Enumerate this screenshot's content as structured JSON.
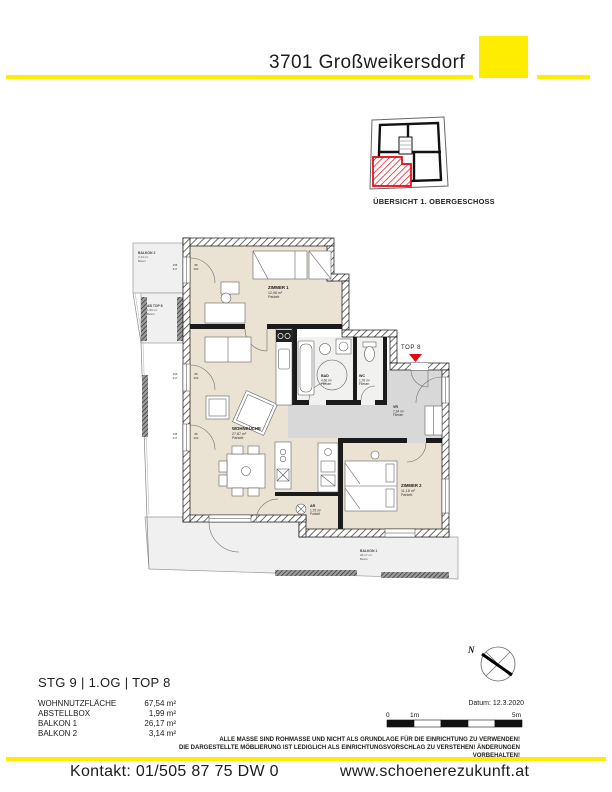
{
  "header": {
    "title": "3701 Großweikersdorf"
  },
  "overview": {
    "caption": "ÜBERSICHT 1. OBERGESCHOSS"
  },
  "plan": {
    "unit_marker": "TOP 8",
    "rooms": {
      "zimmer1": {
        "name": "ZIMMER 1",
        "area": "12,98 m²",
        "floor": "Parkett"
      },
      "wohnkueche": {
        "name": "WOHNKÜCHE",
        "area": "27,87 m²",
        "floor": "Parkett"
      },
      "bad": {
        "name": "BAD",
        "area": "4,66 m²",
        "floor": "Fliesen"
      },
      "wc": {
        "name": "WC",
        "area": "1,76 m²",
        "floor": "Fliesen"
      },
      "vr": {
        "name": "VR",
        "area": "7,34 m²",
        "floor": "Fliesen"
      },
      "zimmer2": {
        "name": "ZIMMER 2",
        "area": "11,18 m²",
        "floor": "Parkett"
      },
      "ar": {
        "name": "AR",
        "area": "1,75 m²",
        "floor": "Parkett"
      },
      "balkon1": {
        "name": "BALKON 1",
        "area": "26,17 m²",
        "floor": "Beton"
      },
      "balkon2": {
        "name": "BALKON 2",
        "area": "3,14 m²",
        "floor": "Beton"
      },
      "abstellbox": {
        "name": "AB TOP 8",
        "area": "1,99 m²",
        "floor": "Beton"
      }
    },
    "window_tags": {
      "outer": [
        "155",
        "217"
      ],
      "inner": [
        "88",
        "200"
      ]
    }
  },
  "summary": {
    "title": "STG 9 | 1.OG | TOP 8",
    "rows": [
      {
        "label": "WOHNNUTZFLÄCHE",
        "value": "67,54 m²"
      },
      {
        "label": "ABSTELLBOX",
        "value": "1,99 m²"
      },
      {
        "label": "BALKON 1",
        "value": "26,17 m²"
      },
      {
        "label": "BALKON 2",
        "value": "3,14 m²"
      }
    ]
  },
  "meta": {
    "date": "Datum: 12.3.2020",
    "north": "N",
    "scale": {
      "zero": "0",
      "one": "1m",
      "five": "5m"
    }
  },
  "disclaimer": {
    "line1": "ALLE MASSE SIND ROHMASSE UND NICHT ALS GRUNDLAGE FÜR DIE EINRICHTUNG ZU VERWENDEN!",
    "line2": "DIE DARGESTELLTE MÖBLIERUNG IST LEDIGLICH ALS EINRICHTUNGSVORSCHLAG ZU VERSTEHEN! ÄNDERUNGEN VORBEHALTEN!"
  },
  "footer": {
    "contact": "Kontakt: 01/505 87 75 DW 0",
    "website": "www.schoenerezukunft.at"
  },
  "colors": {
    "accent_yellow": "#ffed00",
    "highlight_red": "#e30613",
    "room_beige": "#eae2d2",
    "hall_gray": "#d8d8d8",
    "balcony_gray": "#f0f0f0",
    "wall_black": "#1b1b1b"
  }
}
